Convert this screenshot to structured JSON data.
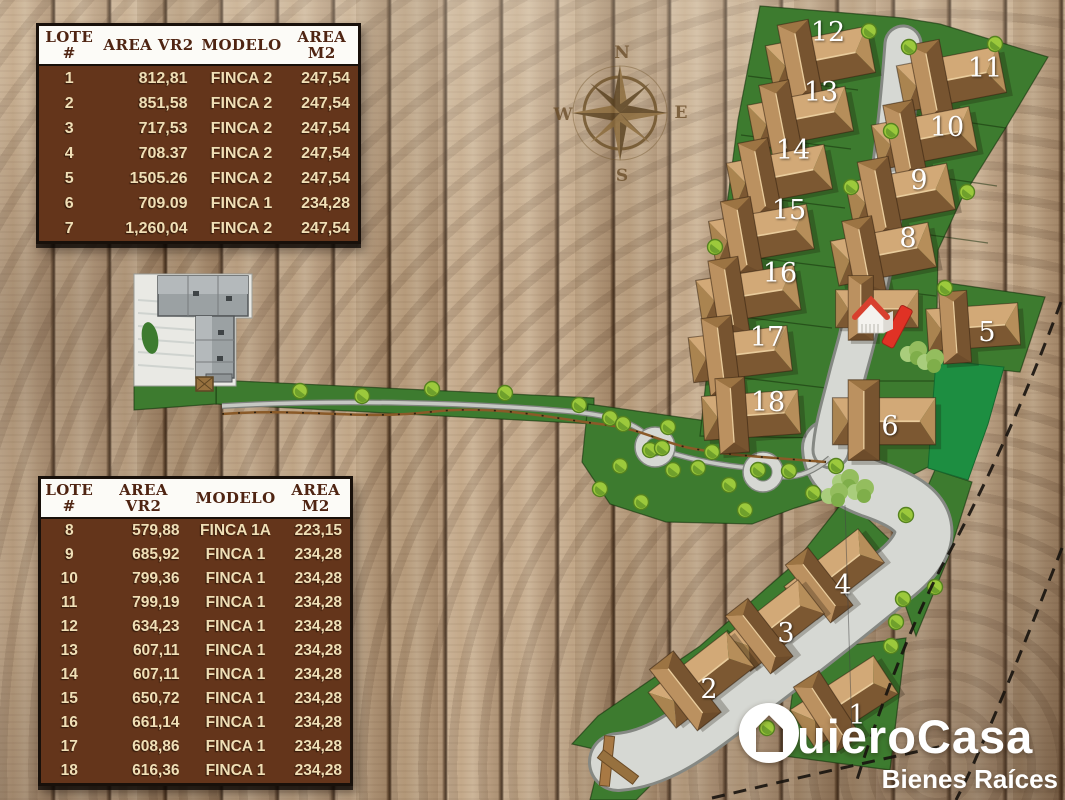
{
  "tables": {
    "top": {
      "headers": [
        [
          "LOTE",
          "#"
        ],
        [
          "AREA VR2",
          ""
        ],
        [
          "MODELO",
          ""
        ],
        [
          "AREA",
          "M2"
        ]
      ],
      "rows": [
        [
          "1",
          "812,81",
          "FINCA 2",
          "247,54"
        ],
        [
          "2",
          "851,58",
          "FINCA 2",
          "247,54"
        ],
        [
          "3",
          "717,53",
          "FINCA 2",
          "247,54"
        ],
        [
          "4",
          "708.37",
          "FINCA 2",
          "247,54"
        ],
        [
          "5",
          "1505.26",
          "FINCA 2",
          "247,54"
        ],
        [
          "6",
          "709.09",
          "FINCA 1",
          "234,28"
        ],
        [
          "7",
          "1,260,04",
          "FINCA 2",
          "247,54"
        ]
      ]
    },
    "bottom": {
      "headers": [
        [
          "LOTE",
          "#"
        ],
        [
          "AREA",
          "VR2"
        ],
        [
          "MODELO",
          ""
        ],
        [
          "AREA",
          "M2"
        ]
      ],
      "rows": [
        [
          "8",
          "579,88",
          "FINCA 1A",
          "223,15"
        ],
        [
          "9",
          "685,92",
          "FINCA 1",
          "234,28"
        ],
        [
          "10",
          "799,36",
          "FINCA 1",
          "234,28"
        ],
        [
          "11",
          "799,19",
          "FINCA 1",
          "234,28"
        ],
        [
          "12",
          "634,23",
          "FINCA 1",
          "234,28"
        ],
        [
          "13",
          "607,11",
          "FINCA 1",
          "234,28"
        ],
        [
          "14",
          "607,11",
          "FINCA 1",
          "234,28"
        ],
        [
          "15",
          "650,72",
          "FINCA 1",
          "234,28"
        ],
        [
          "16",
          "661,14",
          "FINCA 1",
          "234,28"
        ],
        [
          "17",
          "608,86",
          "FINCA 1",
          "234,28"
        ],
        [
          "18",
          "616,36",
          "FINCA 1",
          "234,28"
        ]
      ]
    }
  },
  "compass": {
    "north": "N",
    "south": "S",
    "east": "E",
    "west": "W"
  },
  "plan": {
    "lot_labels": {
      "1": "1",
      "2": "2",
      "3": "3",
      "4": "4",
      "5": "5",
      "6": "6",
      "8": "8",
      "9": "9",
      "10": "10",
      "11": "11",
      "12": "12",
      "13": "13",
      "14": "14",
      "15": "15",
      "16": "16",
      "17": "17",
      "18": "18"
    }
  },
  "logo": {
    "wordmark_rest": "uieroCasa",
    "tagline": "Bienes Raíces"
  },
  "colors": {
    "parcel_green": "#3d7b2f",
    "park_green": "#1d8e41",
    "road_gray": "#d6d8d3",
    "road_casing": "#858883",
    "table_brown": "#64351b",
    "table_header_text": "#4f2412",
    "table_body_text": "#f0dfb6",
    "marker_red": "#e03225",
    "logo_white": "#ffffff",
    "compass_brown": "#6b4e2a",
    "roof_tan": "#d2a977",
    "roof_dark": "#7c5832"
  }
}
